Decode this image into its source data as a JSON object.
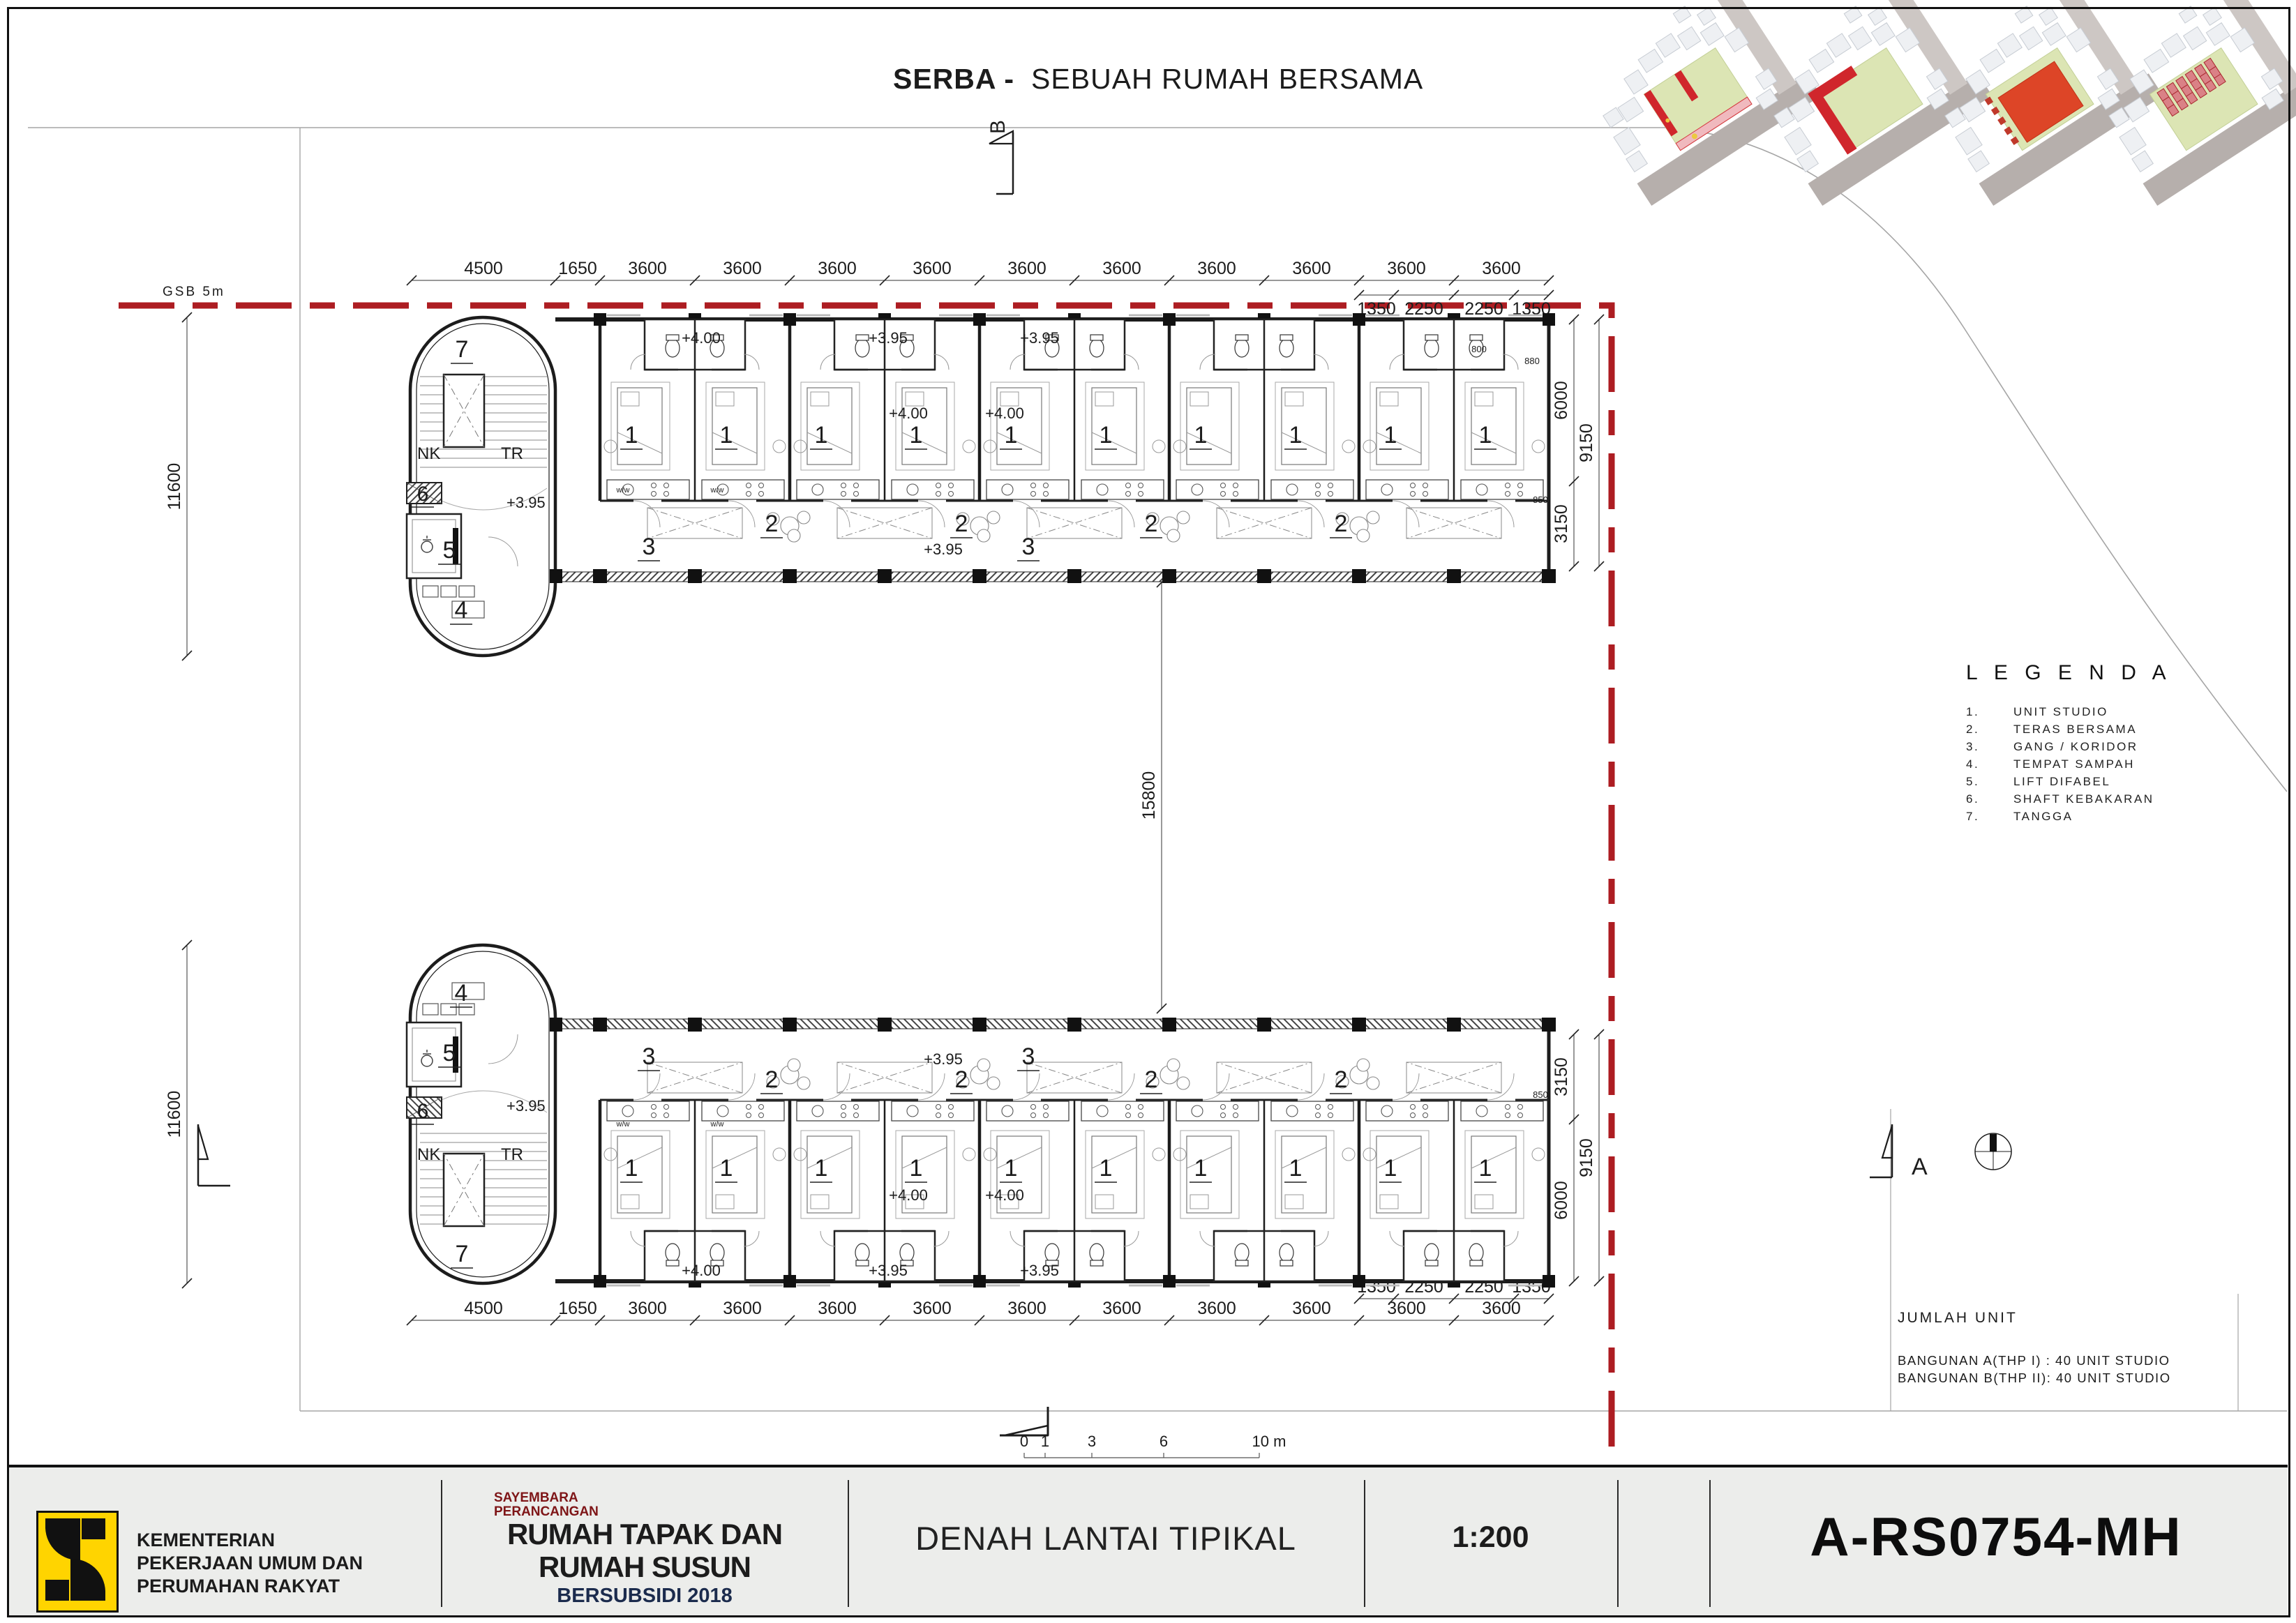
{
  "header": {
    "title_bold": "SERBA -",
    "title_rest": "SEBUAH RUMAH BERSAMA"
  },
  "site": {
    "gsb_top": "GSB 5m",
    "gsb_right": "GSB 8m",
    "section_top": "B",
    "section_right": "A"
  },
  "plan": {
    "room_labels": {
      "unit": "1",
      "terrace": "2",
      "corridor": "3",
      "trash": "4",
      "lift": "5",
      "shaft": "6",
      "stair": "7"
    },
    "core_labels": {
      "nk": "NK",
      "tr": "TR"
    },
    "levels": {
      "l400": "+4.00",
      "l395": "+3.95"
    },
    "small_dims": [
      "800",
      "880",
      "850"
    ],
    "fixture_code": "w/w"
  },
  "dimensions": {
    "top_main": [
      "4500",
      "1650",
      "3600",
      "3600",
      "3600",
      "3600",
      "3600",
      "3600",
      "3600",
      "3600",
      "3600",
      "3600"
    ],
    "top_sub": [
      "1350",
      "2250",
      "2250",
      "1350"
    ],
    "bottom_main": [
      "4500",
      "1650",
      "3600",
      "3600",
      "3600",
      "3600",
      "3600",
      "3600",
      "3600",
      "3600",
      "3600",
      "3600"
    ],
    "bottom_sub": [
      "1350",
      "2250",
      "2250",
      "1350"
    ],
    "left_upper": "11600",
    "left_lower": "11600",
    "right_upper_inner": [
      "6000",
      "3150"
    ],
    "right_upper_outer": "9150",
    "right_lower_inner": [
      "3150",
      "6000"
    ],
    "right_lower_outer": "9150",
    "middle": "15800"
  },
  "scale_bar": {
    "ticks": [
      "0",
      "1",
      "3",
      "6",
      "10 m"
    ]
  },
  "legend": {
    "title": "L E G E N D A",
    "items": [
      [
        "1.",
        "UNIT STUDIO"
      ],
      [
        "2.",
        "TERAS BERSAMA"
      ],
      [
        "3.",
        "GANG / KORIDOR"
      ],
      [
        "4.",
        "TEMPAT SAMPAH"
      ],
      [
        "5.",
        "LIFT DIFABEL"
      ],
      [
        "6.",
        "SHAFT KEBAKARAN"
      ],
      [
        "7.",
        "TANGGA"
      ]
    ]
  },
  "unit_summary": {
    "title": "JUMLAH UNIT",
    "lines": [
      "BANGUNAN A(THP I) : 40 UNIT STUDIO",
      "BANGUNAN B(THP II): 40 UNIT STUDIO"
    ]
  },
  "titleblock": {
    "ministry": [
      "KEMENTERIAN",
      "PEKERJAAN UMUM DAN",
      "PERUMAHAN RAKYAT"
    ],
    "program_small": [
      "SAYEMBARA",
      "PERANCANGAN"
    ],
    "program_main": [
      "RUMAH TAPAK DAN",
      "RUMAH SUSUN"
    ],
    "program_sub": "BERSUBSIDI 2018",
    "drawing_title": "DENAH LANTAI TIPIKAL",
    "scale": "1:200",
    "sheet_code": "A-RS0754-MH"
  },
  "colors": {
    "ink": "#1c1c1c",
    "light_line": "#a5a5a5",
    "red_gsb": "#ad1d22",
    "titlebar_bg": "#ecedeb",
    "logo_yellow": "#ffd400",
    "program_red": "#7e1517",
    "program_navy": "#1b2b4d",
    "thumb_green": "#dce5b4",
    "thumb_road": "#b6afac",
    "thumb_block": "#eef0f3",
    "thumb_red": "#d0262c",
    "thumb_orange": "#dd4527"
  }
}
